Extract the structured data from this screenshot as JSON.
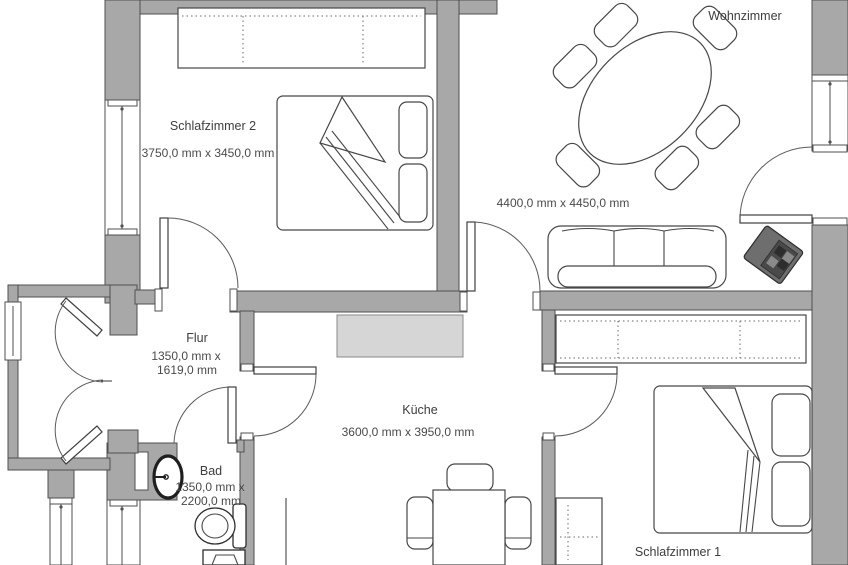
{
  "plan": {
    "title": "Apartment floor plan",
    "rooms": {
      "wohnzimmer": {
        "label": "Wohnzimmer",
        "dims": "4400,0 mm x 4450,0 mm"
      },
      "schlafzimmer2": {
        "label": "Schlafzimmer 2",
        "dims": "3750,0 mm x 3450,0 mm"
      },
      "flur": {
        "label": "Flur",
        "dims1": "1350,0 mm x",
        "dims2": "1619,0 mm"
      },
      "kueche": {
        "label": "Küche",
        "dims": "3600,0 mm x 3950,0 mm"
      },
      "bad": {
        "label": "Bad",
        "dims1": "1350,0 mm x",
        "dims2": "2200,0 mm"
      },
      "schlafzimmer1": {
        "label": "Schlafzimmer 1"
      }
    },
    "colors": {
      "wall_fill": "#a8a8a8",
      "wall_stroke": "#4f4f4f",
      "furniture_stroke": "#474747",
      "counter_fill": "#d6d6d6",
      "speaker_body": "#6e6e6e",
      "speaker_dark": "#2d2d2d",
      "text": "#3d3d3d",
      "background": "#ffffff"
    }
  }
}
